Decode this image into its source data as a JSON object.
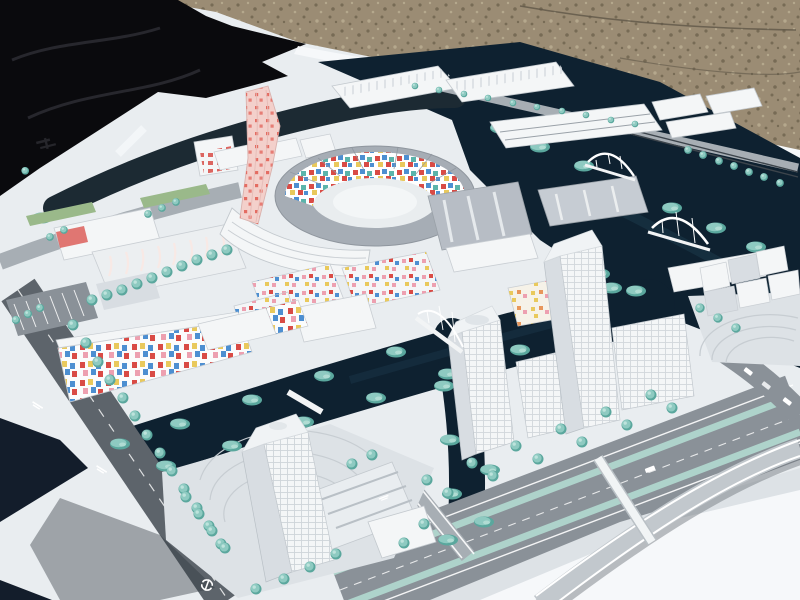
{
  "meta": {
    "title": "Photograph of a white architectural scale model of a waterfront urban district, displayed outdoors on a table with a black tarp and gravel ground behind it"
  },
  "palette": {
    "gravel": "#9b8c74",
    "gravelDark": "#776b55",
    "gravelLight": "#b5a88d",
    "tarp": "#0a0a0d",
    "tarpSheen": "#2a2a31",
    "board": "#e9edf0",
    "boardBright": "#f6f8fa",
    "boardShade": "#cfd5da",
    "tableDark": "#131d2b",
    "water": "#0e2130",
    "waterLight": "#1f3d50",
    "canalShadow": "#1c2a33",
    "tree": "#8ecac1",
    "treeDark": "#5aa79d",
    "treeLight": "#c6e8e0",
    "road": "#8a9198",
    "roadDark": "#5d646b",
    "roadLight": "#a7aeb4",
    "railSteel": "#3c444b",
    "building": "#f4f6f7",
    "buildingShade": "#d8dde2",
    "roof": "#a6adb5",
    "glass": "#b7bdc5",
    "glassDark": "#c6ccd3",
    "pinkTower": "#f3d0cb",
    "pinkDot": "#e25a50",
    "mosaicRed": "#d94b45",
    "mosaicBlue": "#4d8fd1",
    "mosaicYellow": "#e9c95c",
    "mosaicPink": "#eda0b0",
    "mosaicTeal": "#5bb4ab",
    "mosaicOrange": "#e8965a",
    "lawnGreen": "#9ab98a",
    "medianTeal": "#aed3cb",
    "marking": "#f2f4f5",
    "paving": "#dde2e6",
    "pavingArc": "#c7cdd2",
    "shadowCast": "#2c343c"
  },
  "scene": {
    "setting": "outdoor daylight photo, high oblique angle",
    "background_objects": [
      "black plastic tarp upper-left",
      "brown gravel ground upper-right",
      "white model baseboard"
    ],
    "model_objects": [
      {
        "name": "pink-speckled-tower",
        "desc": "tall twisted landmark tower, pale pink with red speckles"
      },
      {
        "name": "circular-arena-plaza",
        "desc": "ring of curved buildings around oval plaza, inner facades with colorful mosaic tiles"
      },
      {
        "name": "mosaic-facade-building",
        "desc": "long low building with scattered red, blue, yellow and pink facade squares"
      },
      {
        "name": "dotted-housing-blocks",
        "desc": "white courtyard blocks with pastel colored window dots"
      },
      {
        "name": "glass-slab-buildings",
        "desc": "grey reflective slab blocks east of the arena"
      },
      {
        "name": "bottom-center-tower",
        "desc": "tall translucent white tower with sawtooth-roof podium on canal island"
      },
      {
        "name": "right-tower-cluster",
        "desc": "two high-rise towers with gridded windows plus mid-rise slabs"
      },
      {
        "name": "cube-cluster",
        "desc": "dense group of small white cubic volumes, far right"
      },
      {
        "name": "canals",
        "desc": "dark navy water channels with teal shrub banks"
      },
      {
        "name": "arch-footbridges",
        "desc": "three white arched bridges over canals"
      },
      {
        "name": "boulevard",
        "desc": "wide grey boulevard with two pale teal median strips"
      },
      {
        "name": "flyover-ramp",
        "desc": "curved elevated road ramp, bottom right"
      },
      {
        "name": "street-trees",
        "desc": "rows of round teal model trees"
      },
      {
        "name": "road-glyphs",
        "desc": "small illegible white symbols painted on dark roads"
      },
      {
        "name": "board-logo-mark",
        "desc": "small dark illegible logo printed on white baseboard, left edge"
      }
    ]
  }
}
